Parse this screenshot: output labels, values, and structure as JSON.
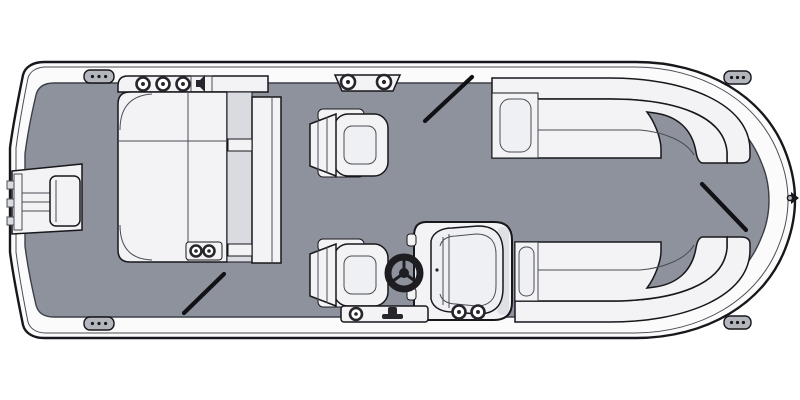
{
  "meta": {
    "diagram_type": "pontoon-boat-floorplan-top-view",
    "orientation": "bow-right-stern-left"
  },
  "colors": {
    "page_bg": "#ffffff",
    "deck": "#8e929c",
    "hull_band": "#fbfbfc",
    "outline_dark": "#17171c",
    "outline_mid": "#4a4d55",
    "furniture_fill": "#f3f3f5",
    "furniture_shade": "#d9dbe1",
    "furniture_inner": "#eef0f3",
    "gate_marker": "#111116",
    "fitting_dark": "#26262c",
    "cap_fill": "#b3b6bd"
  },
  "parts": {
    "hull": "pontoon-hull-outline",
    "deck": "deck-floor",
    "motor_well": "stern-motor-well",
    "stern_lounge": "aft-l-lounge-with-backrest-panel",
    "accessory_strip": "speaker-cupholder-strip",
    "captain_chairs": "two-swivel-captain-chairs",
    "helm": "helm-console-with-steering-wheel",
    "bow_lounges": "port-and-starboard-wraparound-bow-lounges",
    "ski_tow": "ski-tow-plate",
    "step_plate": "boarding-step-with-cleat"
  },
  "fittings": {
    "stern_speakers": {
      "cx": [
        143,
        163,
        183
      ],
      "cy": 84,
      "r": 6.5
    },
    "ski_tow_eyes": {
      "cx": [
        348,
        384
      ],
      "cy": 82,
      "r": 7
    },
    "lounge_cupholders": {
      "cx": [
        196,
        209
      ],
      "cy": 251,
      "r": 5.5
    },
    "console_cupholders": {
      "cx": [
        459,
        478
      ],
      "cy": 312,
      "r": 6.5
    },
    "step_light": {
      "cx": [
        356
      ],
      "cy": 314,
      "r": 6
    },
    "corner_caps": [
      {
        "x": 84,
        "y": 70,
        "w": 30,
        "h": 13
      },
      {
        "x": 84,
        "y": 317,
        "w": 30,
        "h": 13
      },
      {
        "x": 724,
        "y": 71,
        "w": 27,
        "h": 13
      },
      {
        "x": 724,
        "y": 316,
        "w": 27,
        "h": 13
      }
    ]
  },
  "gates": [
    {
      "name": "gate-aft-bottom",
      "x1": 184,
      "y1": 313,
      "x2": 224,
      "y2": 274
    },
    {
      "name": "gate-mid-top",
      "x1": 425,
      "y1": 121,
      "x2": 472,
      "y2": 77
    },
    {
      "name": "gate-bow",
      "x1": 702,
      "y1": 184,
      "x2": 746,
      "y2": 230
    }
  ]
}
